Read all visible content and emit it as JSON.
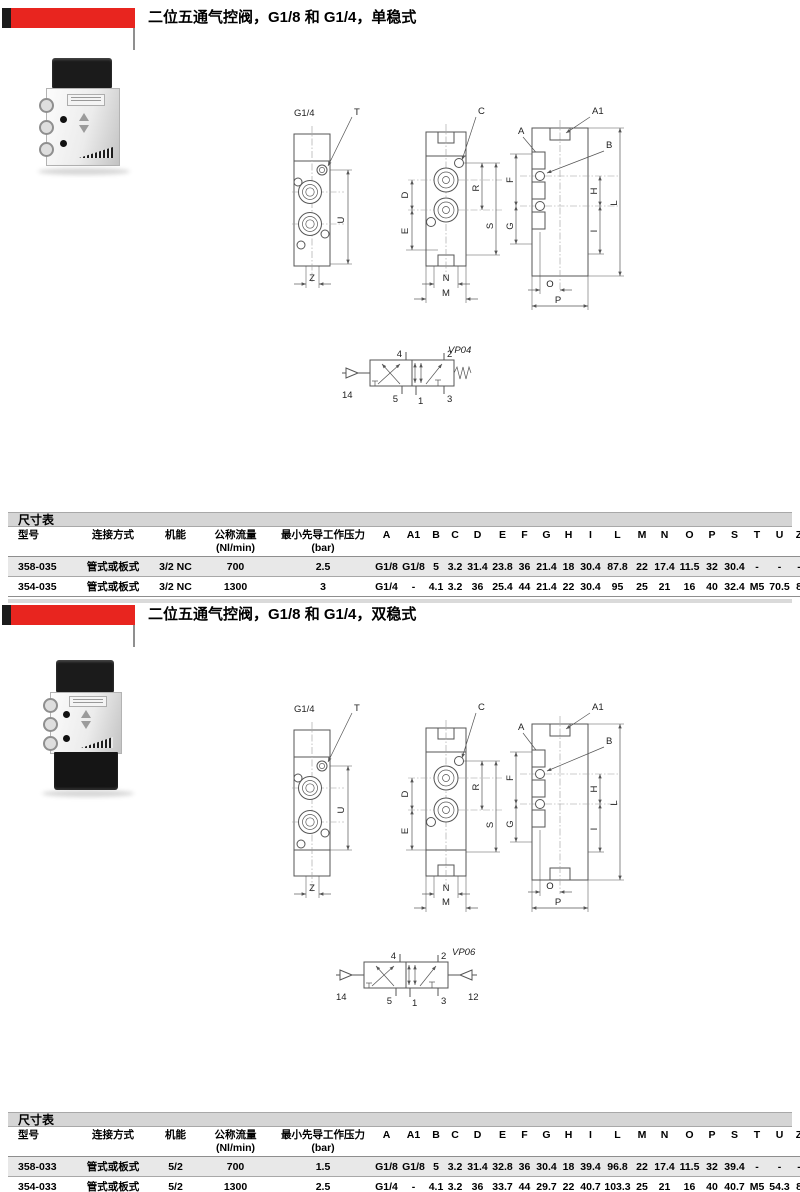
{
  "accent_color": "#e8251f",
  "dim_labels": {
    "g14": "G1/4",
    "t": "T",
    "u": "U",
    "z": "Z",
    "c": "C",
    "d": "D",
    "e": "E",
    "r": "R",
    "s": "S",
    "n": "N",
    "m": "M",
    "a1": "A1",
    "a": "A",
    "b": "B",
    "f": "F",
    "g": "G",
    "h": "H",
    "i": "I",
    "l": "L",
    "o": "O",
    "p": "P"
  },
  "sections": [
    {
      "title": "二位五通气控阀，G1/8 和 G1/4，单稳式",
      "symbol": {
        "name": "VP04",
        "ports": {
          "p14": "14",
          "p4": "4",
          "p2": "2",
          "p5": "5",
          "p1": "1",
          "p3": "3"
        }
      },
      "table": {
        "caption": "尺寸表",
        "headers": [
          "型号",
          "连接方式",
          "机能",
          "公称流量\n(Nl/min)",
          "最小先导工作压力\n(bar)",
          "A",
          "A1",
          "B",
          "C",
          "D",
          "E",
          "F",
          "G",
          "H",
          "I",
          "L",
          "M",
          "N",
          "O",
          "P",
          "S",
          "T",
          "U",
          "Z"
        ],
        "rows": [
          [
            "358-035",
            "管式或板式",
            "3/2 NC",
            "700",
            "2.5",
            "G1/8",
            "G1/8",
            "5",
            "3.2",
            "31.4",
            "23.8",
            "36",
            "21.4",
            "18",
            "30.4",
            "87.8",
            "22",
            "17.4",
            "11.5",
            "32",
            "30.4",
            "-",
            "-",
            "-"
          ],
          [
            "354-035",
            "管式或板式",
            "3/2 NC",
            "1300",
            "3",
            "G1/4",
            "-",
            "4.1",
            "3.2",
            "36",
            "25.4",
            "44",
            "21.4",
            "22",
            "30.4",
            "95",
            "25",
            "21",
            "16",
            "40",
            "32.4",
            "M5",
            "70.5",
            "8"
          ]
        ]
      }
    },
    {
      "title": "二位五通气控阀，G1/8 和 G1/4，双稳式",
      "symbol": {
        "name": "VP06",
        "ports": {
          "p14": "14",
          "p4": "4",
          "p2": "2",
          "p5": "5",
          "p1": "1",
          "p3": "3",
          "p12": "12"
        }
      },
      "table": {
        "caption": "尺寸表",
        "headers": [
          "型号",
          "连接方式",
          "机能",
          "公称流量\n(Nl/min)",
          "最小先导工作压力\n(bar)",
          "A",
          "A1",
          "B",
          "C",
          "D",
          "E",
          "F",
          "G",
          "H",
          "I",
          "L",
          "M",
          "N",
          "O",
          "P",
          "S",
          "T",
          "U",
          "Z"
        ],
        "rows": [
          [
            "358-033",
            "管式或板式",
            "5/2",
            "700",
            "1.5",
            "G1/8",
            "G1/8",
            "5",
            "3.2",
            "31.4",
            "32.8",
            "36",
            "30.4",
            "18",
            "39.4",
            "96.8",
            "22",
            "17.4",
            "11.5",
            "32",
            "39.4",
            "-",
            "-",
            "-"
          ],
          [
            "354-033",
            "管式或板式",
            "5/2",
            "1300",
            "2.5",
            "G1/4",
            "-",
            "4.1",
            "3.2",
            "36",
            "33.7",
            "44",
            "29.7",
            "22",
            "40.7",
            "103.3",
            "25",
            "21",
            "16",
            "40",
            "40.7",
            "M5",
            "54.3",
            "8"
          ]
        ]
      }
    }
  ]
}
